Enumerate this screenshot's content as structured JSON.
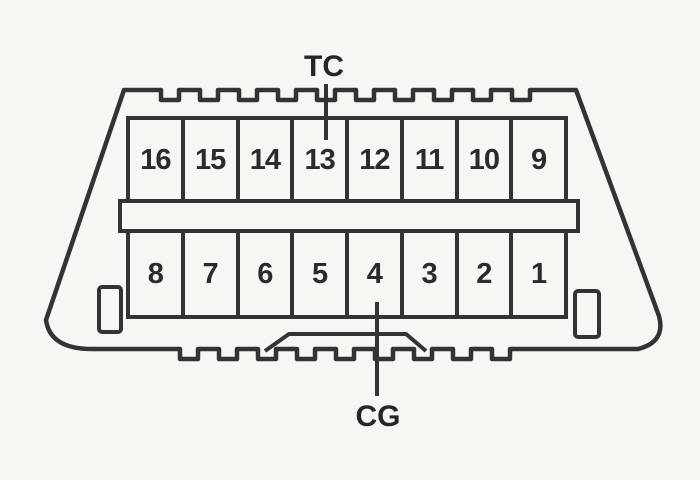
{
  "labels": {
    "tc": "TC",
    "cg": "CG"
  },
  "pins": {
    "top": [
      "16",
      "15",
      "14",
      "13",
      "12",
      "11",
      "10",
      "9"
    ],
    "bottom": [
      "8",
      "7",
      "6",
      "5",
      "4",
      "3",
      "2",
      "1"
    ]
  },
  "annotations": {
    "tc_points_to_pin": "13",
    "cg_points_to_pin": "4"
  },
  "colors": {
    "background": "#f7f6f2",
    "line": "#333333",
    "text": "#2b2b2b"
  }
}
